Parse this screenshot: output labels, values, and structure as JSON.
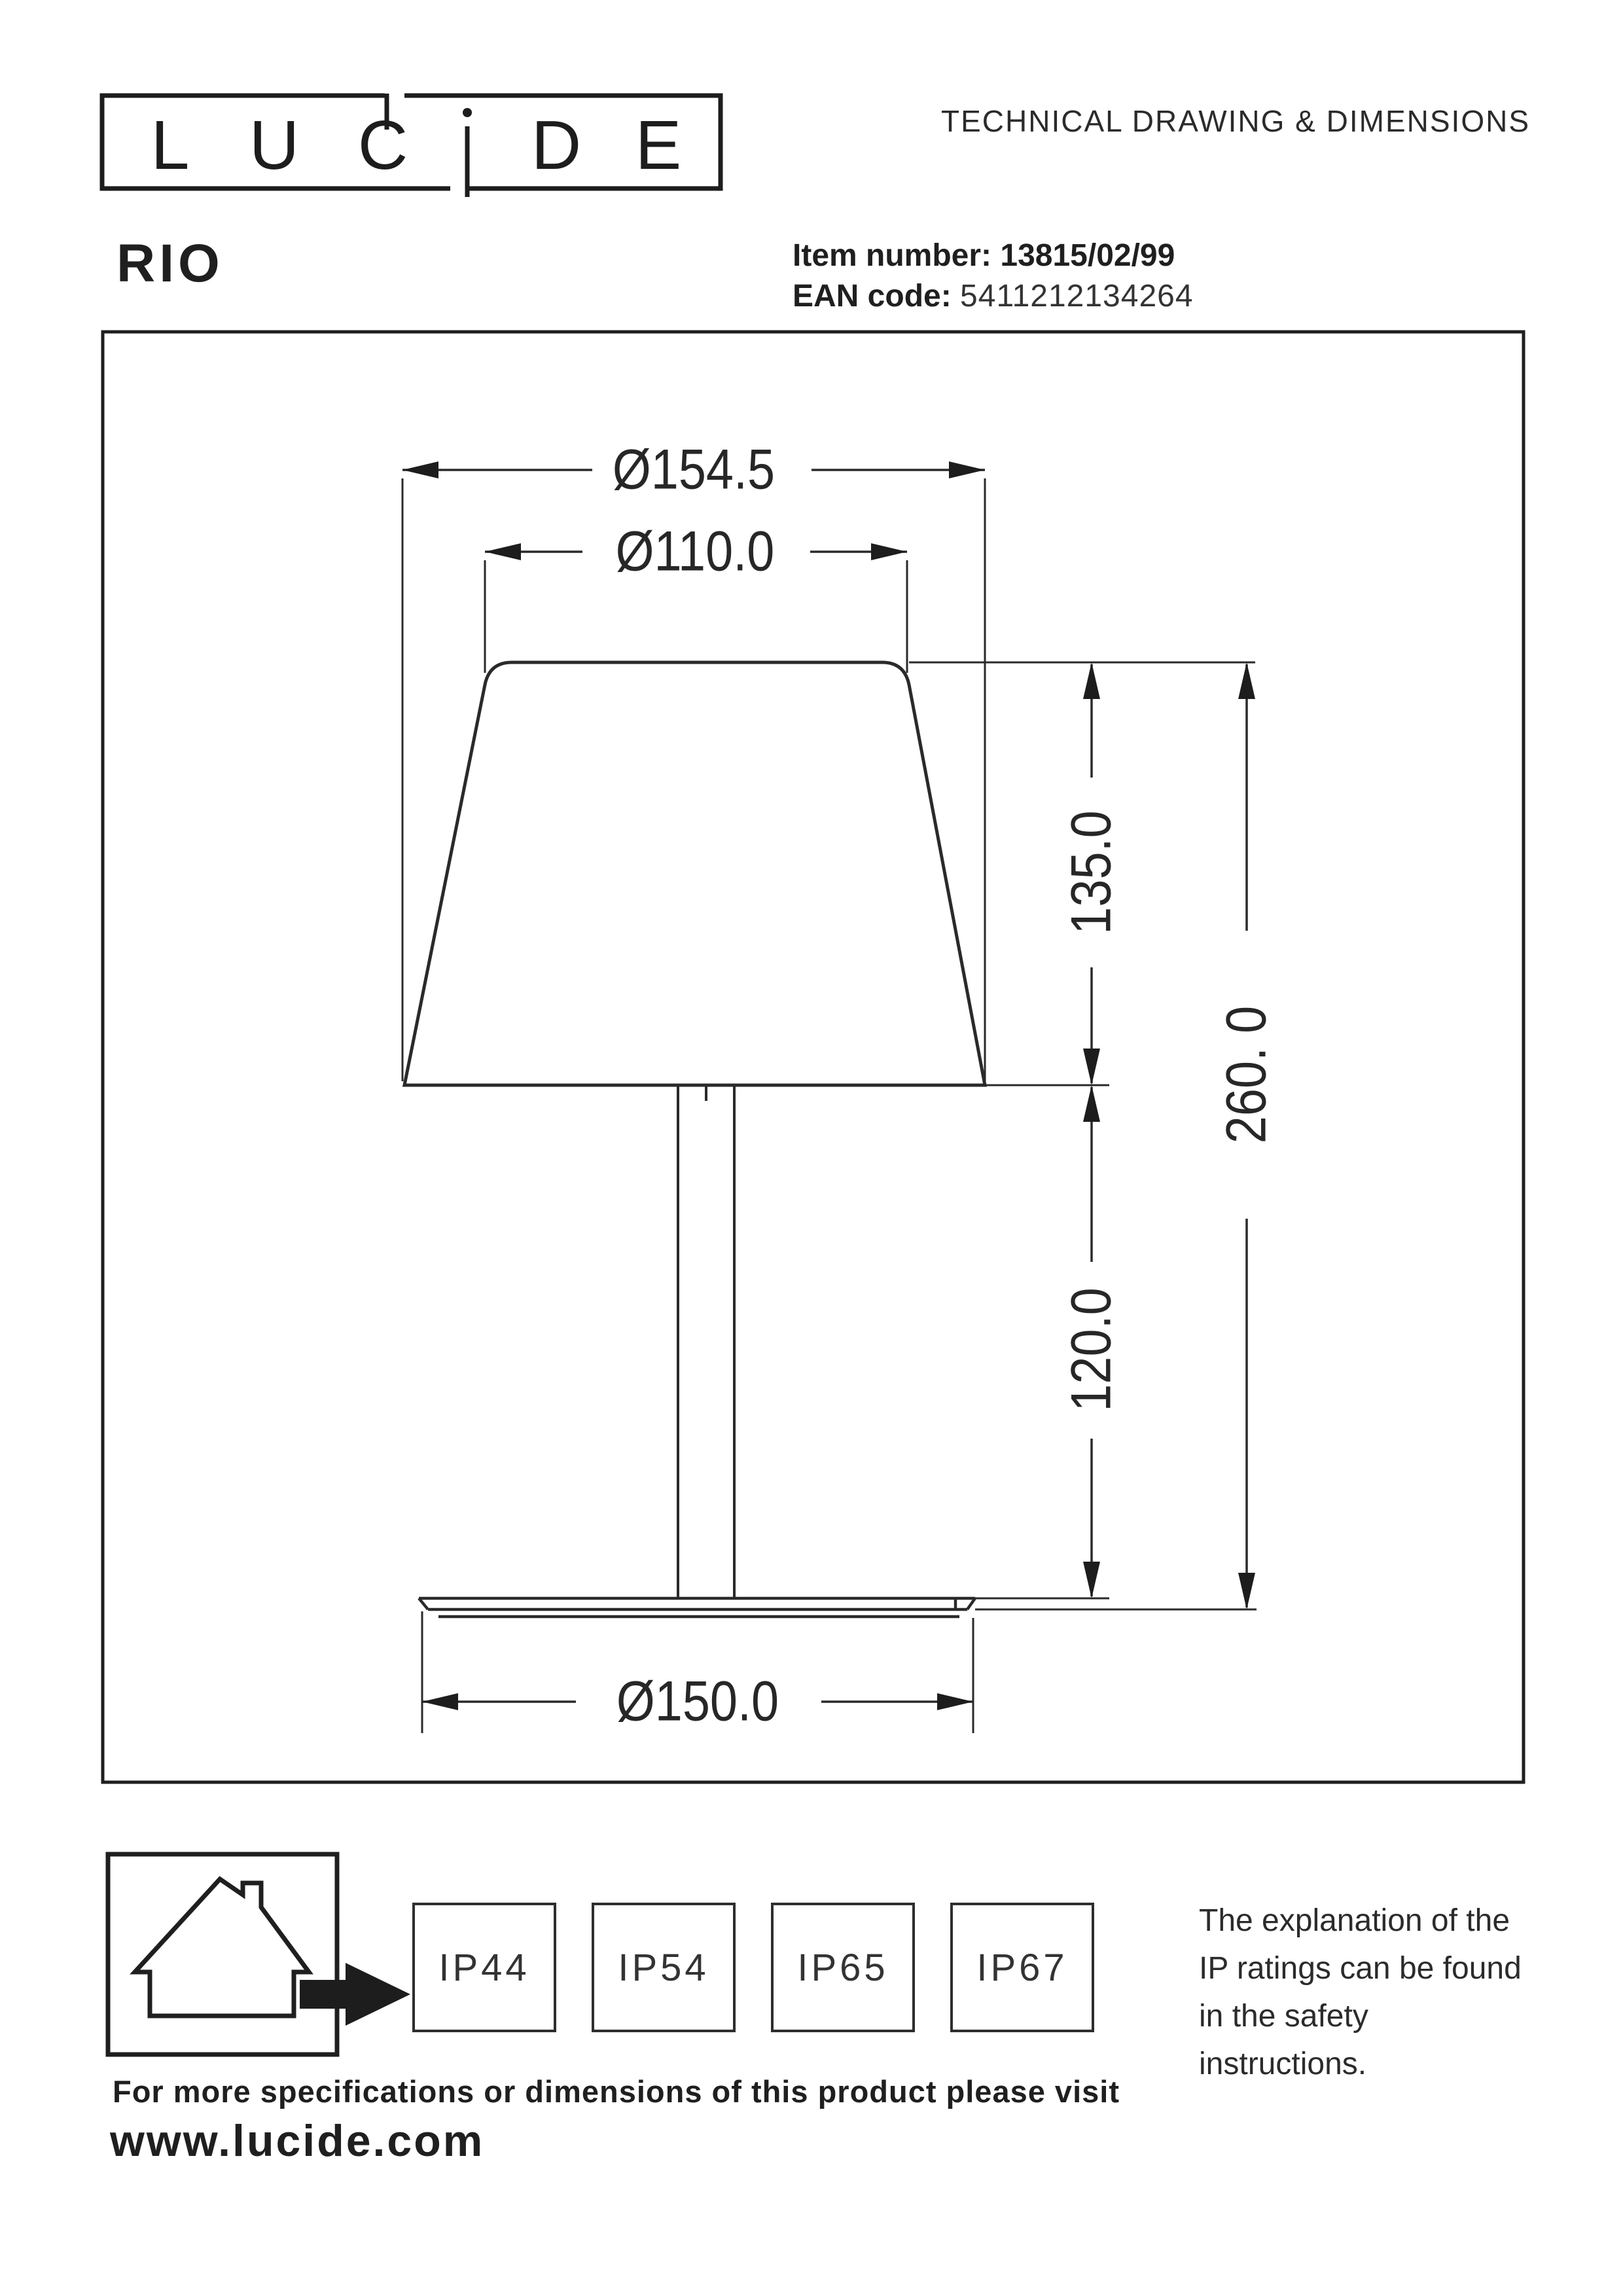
{
  "colors": {
    "ink": "#262626",
    "line": "#2a2a2a",
    "arrow_fill": "#1d1d1d"
  },
  "header": {
    "logo": {
      "name": "Lucide",
      "letters": [
        "L",
        "U",
        "C",
        "i",
        "D",
        "E"
      ]
    },
    "title": "TECHNICAL DRAWING & DIMENSIONS"
  },
  "product": {
    "name": "RIO",
    "item_label": "Item number:",
    "item_value": "13815/02/99",
    "ean_label": "EAN code:",
    "ean_value": "5411212134264"
  },
  "drawing": {
    "dimensions": {
      "shade_top_outer": "Ø154.5",
      "shade_top_inner": "Ø110.0",
      "shade_height": "135.0",
      "total_height": "260. 0",
      "stem_height": "120.0",
      "base_diameter": "Ø150.0"
    }
  },
  "ratings": {
    "boxes": [
      "IP44",
      "IP54",
      "IP65",
      "IP67"
    ],
    "note_lines": [
      "The explanation of the",
      "IP ratings can be found",
      "in the safety",
      "instructions."
    ]
  },
  "footer": {
    "line1": "For more specifications or dimensions of this product please visit",
    "line2": "www.lucide.com"
  }
}
